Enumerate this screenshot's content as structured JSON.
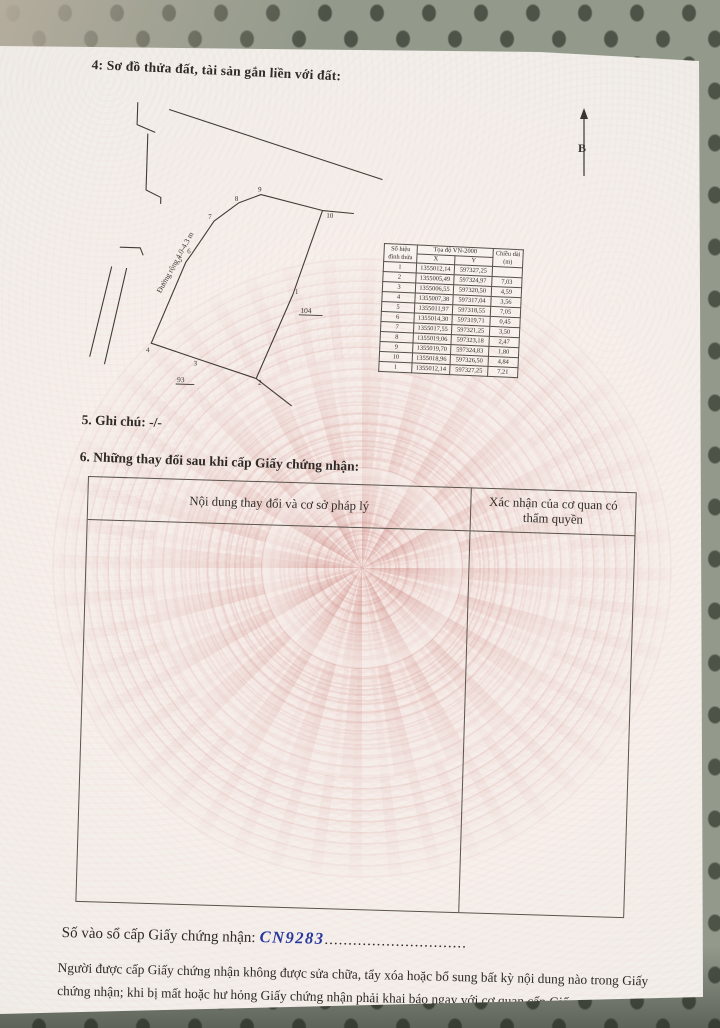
{
  "document": {
    "section4_title": "4: Sơ đồ thửa đất, tài sản gắn liền với đất:",
    "section5_text": "5. Ghi chú: -/-",
    "section6_title": "6. Những thay đổi sau khi cấp Giấy chứng nhận:",
    "changes_table": {
      "col1_header": "Nội dung thay đổi và cơ sở pháp lý",
      "col2_header": "Xác nhận của cơ quan có thẩm quyền"
    },
    "registry_label": "Số vào sổ cấp Giấy chứng nhận:",
    "registry_number": "CN9283",
    "registry_dots": "..............................",
    "footer_note": "Người được cấp Giấy chứng nhận không được sửa chữa, tẩy xóa hoặc bổ sung bất kỳ nội dung nào trong Giấy chứng nhận; khi bị mất hoặc hư hỏng Giấy chứng nhận phải khai báo ngay với cơ quan cấp Giấy."
  },
  "diagram": {
    "north_label": "B",
    "road_label": "Đường rộng 4.0-4.3 m",
    "parcel_104": "104",
    "parcel_93": "93",
    "vertex_labels": [
      "1",
      "2",
      "3",
      "4",
      "5",
      "6",
      "7",
      "8",
      "9",
      "10"
    ]
  },
  "coordinate_table": {
    "header_vertex": "Số hiệu đỉnh thửa",
    "header_coords": "Tọa độ VN-2000",
    "header_x": "X",
    "header_y": "Y",
    "header_length": "Chiều dài (m)",
    "rows": [
      [
        "1",
        "1355012,14",
        "597327,25",
        ""
      ],
      [
        "2",
        "1355005,49",
        "597324,97",
        "7,03"
      ],
      [
        "3",
        "1355006,55",
        "597320,50",
        "4,59"
      ],
      [
        "4",
        "1355007,38",
        "597317,04",
        "3,56"
      ],
      [
        "5",
        "1355011,97",
        "597318,55",
        "7,05"
      ],
      [
        "6",
        "1355014,30",
        "597319,71",
        "0,45"
      ],
      [
        "7",
        "1355017,55",
        "597321,25",
        "3,50"
      ],
      [
        "8",
        "1355019,06",
        "597323,18",
        "2,47"
      ],
      [
        "9",
        "1355019,70",
        "597324,83",
        "1,80"
      ],
      [
        "10",
        "1355018,96",
        "597326,50",
        "4,84"
      ],
      [
        "1",
        "1355012,14",
        "597327,25",
        "7,21"
      ]
    ]
  },
  "colors": {
    "ink": "#2f2a26",
    "handwriting": "#27379e",
    "paper": "#f6efeb",
    "metal": "#939a8c"
  }
}
